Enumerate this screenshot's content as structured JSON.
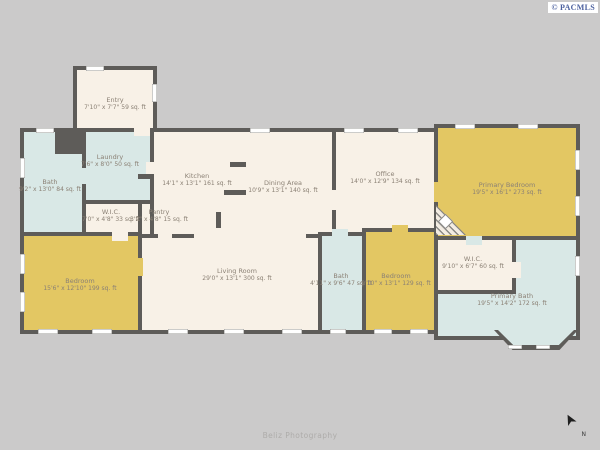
{
  "watermarks": {
    "copyright": "© PACMLS",
    "credit": "Beliz Photography"
  },
  "compass": {
    "label": "N"
  },
  "palette": {
    "background": "#cbcaca",
    "wall": "#5e5c59",
    "floor_main": "#f8f1e7",
    "floor_bedroom": "#e3c763",
    "floor_wet": "#d9e8e6",
    "label_text": "#8b8175",
    "copyright_blue": "#4a5f9e"
  },
  "rooms": {
    "entry": {
      "name": "Entry",
      "dims": "7'10\" x 7'7\" 59 sq. ft"
    },
    "bath_left": {
      "name": "Bath",
      "dims": "9'2\" x 13'0\" 84 sq. ft"
    },
    "laundry": {
      "name": "Laundry",
      "dims": "7'6\" x 8'0\" 50 sq. ft"
    },
    "wic_left": {
      "name": "W.I.C.",
      "dims": "7'0\" x 4'8\" 33 sq. ft"
    },
    "pantry": {
      "name": "Pantry",
      "dims": "3'2\" x 4'8\" 15 sq. ft"
    },
    "kitchen": {
      "name": "Kitchen",
      "dims": "14'1\" x 13'1\" 161 sq. ft"
    },
    "dining": {
      "name": "Dining Area",
      "dims": "10'9\" x 13'1\" 140 sq. ft"
    },
    "office": {
      "name": "Office",
      "dims": "14'0\" x 12'9\" 134 sq. ft"
    },
    "primary_bedroom": {
      "name": "Primary Bedroom",
      "dims": "19'5\" x 16'1\" 273 sq. ft"
    },
    "living_room": {
      "name": "Living Room",
      "dims": "29'0\" x 13'1\" 300 sq. ft"
    },
    "bedroom_left": {
      "name": "Bedroom",
      "dims": "15'6\" x 12'10\" 199 sq. ft"
    },
    "bath_middle": {
      "name": "Bath",
      "dims": "4'11\" x 9'6\" 47 sq. ft"
    },
    "bedroom_middle": {
      "name": "Bedroom",
      "dims": "9'10\" x 13'1\" 129 sq. ft"
    },
    "wic_right": {
      "name": "W.I.C.",
      "dims": "9'10\" x 6'7\" 60 sq. ft"
    },
    "primary_bath": {
      "name": "Primary Bath",
      "dims": "19'5\" x 14'2\" 172 sq. ft"
    }
  }
}
